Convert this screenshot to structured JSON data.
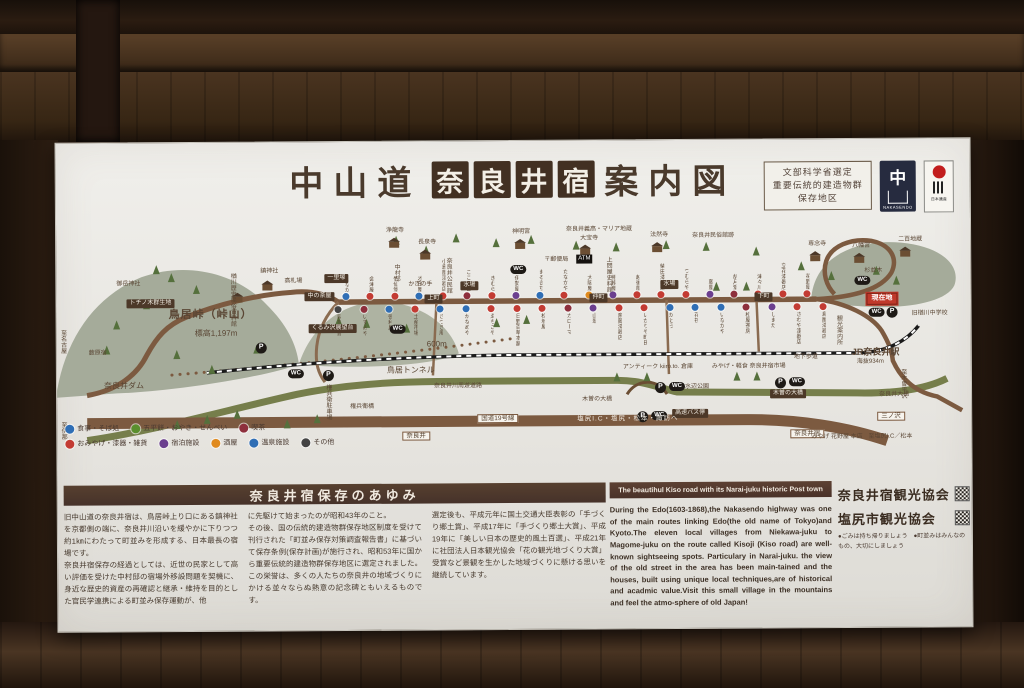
{
  "sign": {
    "title": {
      "prefix": "中山道",
      "highlight": [
        "奈",
        "良",
        "井",
        "宿"
      ],
      "suffix": "案内図"
    },
    "badges": {
      "selection": [
        "文部科学省選定",
        "重要伝統的建造物群",
        "保存地区"
      ],
      "nakasendo": {
        "char": "中",
        "caption": "NAKASENDO"
      },
      "heritage": {
        "caption": "日本遺産"
      }
    }
  },
  "map": {
    "labels": [
      {
        "x": 2,
        "y": 104,
        "t": "至名古屋",
        "k": "v"
      },
      {
        "x": 2,
        "y": 196,
        "t": "至伊那",
        "k": "v"
      },
      {
        "x": 32,
        "y": 125,
        "t": "薮原宿",
        "k": "t"
      },
      {
        "x": 60,
        "y": 56,
        "t": "御岳神社",
        "k": "t"
      },
      {
        "x": 70,
        "y": 74,
        "t": "トチノ木群生地",
        "k": "c"
      },
      {
        "x": 268,
        "y": 50,
        "t": "一里塚",
        "k": "c"
      },
      {
        "x": 248,
        "y": 68,
        "t": "中の茶屋",
        "k": "c"
      },
      {
        "x": 112,
        "y": 84,
        "t": "鳥居峠（峠山）",
        "k": "b"
      },
      {
        "x": 138,
        "y": 104,
        "t": "標高1,197m",
        "k": "p"
      },
      {
        "x": 252,
        "y": 100,
        "t": "くるみ沢展望台",
        "k": "c"
      },
      {
        "x": 370,
        "y": 116,
        "t": "600m",
        "k": "p"
      },
      {
        "x": 330,
        "y": 142,
        "t": "鳥居トンネル",
        "k": "p"
      },
      {
        "x": 47,
        "y": 156,
        "t": "奈良井ダム",
        "k": "p"
      },
      {
        "x": 172,
        "y": 48,
        "t": "楢川歴史民俗資料館",
        "k": "v"
      },
      {
        "x": 204,
        "y": 44,
        "t": "鎮神社",
        "k": "t"
      },
      {
        "x": 228,
        "y": 54,
        "t": "高札場",
        "k": "t"
      },
      {
        "x": 330,
        "y": 4,
        "t": "浄龍寺",
        "k": "t"
      },
      {
        "x": 362,
        "y": 16,
        "t": "長泉寺",
        "k": "t"
      },
      {
        "x": 388,
        "y": 34,
        "t": "奈良井公民館",
        "k": "v"
      },
      {
        "x": 336,
        "y": 40,
        "t": "中村邸",
        "k": "v"
      },
      {
        "x": 352,
        "y": 58,
        "t": "かぎの手",
        "k": "t"
      },
      {
        "x": 404,
        "y": 58,
        "t": "水場",
        "k": "c"
      },
      {
        "x": 604,
        "y": 58,
        "t": "水場",
        "k": "c"
      },
      {
        "x": 456,
        "y": 6,
        "t": "神明宮",
        "k": "t"
      },
      {
        "x": 488,
        "y": 34,
        "t": "〒郵便局",
        "k": "t"
      },
      {
        "x": 520,
        "y": 32,
        "t": "ATM",
        "k": "cb"
      },
      {
        "x": 510,
        "y": 4,
        "t": "奈良井義高・マリア地蔵",
        "k": "t"
      },
      {
        "x": 524,
        "y": 13,
        "t": "大宝寺",
        "k": "t"
      },
      {
        "x": 594,
        "y": 10,
        "t": "法然寺",
        "k": "t"
      },
      {
        "x": 636,
        "y": 11,
        "t": "奈良井民俗館跡",
        "k": "t"
      },
      {
        "x": 548,
        "y": 34,
        "t": "上問屋史料館",
        "k": "v"
      },
      {
        "x": 752,
        "y": 20,
        "t": "専念寺",
        "k": "t"
      },
      {
        "x": 796,
        "y": 22,
        "t": "八幡宮",
        "k": "t"
      },
      {
        "x": 842,
        "y": 16,
        "t": "二百地蔵",
        "k": "t"
      },
      {
        "x": 808,
        "y": 47,
        "t": "杉並木",
        "k": "t"
      },
      {
        "x": 454,
        "y": 42,
        "t": "WC",
        "k": "w"
      },
      {
        "x": 798,
        "y": 55,
        "t": "WC",
        "k": "w"
      },
      {
        "x": 333,
        "y": 101,
        "t": "WC",
        "k": "w"
      },
      {
        "x": 231,
        "y": 145,
        "t": "WC",
        "k": "w"
      },
      {
        "x": 266,
        "y": 146,
        "t": "P",
        "k": "pk"
      },
      {
        "x": 199,
        "y": 118,
        "t": "P",
        "k": "pk"
      },
      {
        "x": 830,
        "y": 86,
        "t": "P",
        "k": "pk"
      },
      {
        "x": 812,
        "y": 87,
        "t": "WC",
        "k": "w"
      },
      {
        "x": 598,
        "y": 160,
        "t": "P",
        "k": "pk"
      },
      {
        "x": 612,
        "y": 160,
        "t": "WC",
        "k": "w"
      },
      {
        "x": 580,
        "y": 189,
        "t": "P",
        "k": "pk"
      },
      {
        "x": 594,
        "y": 189,
        "t": "WC",
        "k": "w"
      },
      {
        "x": 718,
        "y": 156,
        "t": "P",
        "k": "pk"
      },
      {
        "x": 732,
        "y": 156,
        "t": "WC",
        "k": "w"
      },
      {
        "x": 810,
        "y": 72,
        "t": "現在地",
        "k": "here"
      },
      {
        "x": 778,
        "y": 94,
        "t": "観光案内所",
        "k": "v"
      },
      {
        "x": 795,
        "y": 126,
        "t": "JR奈良井駅",
        "k": "pb"
      },
      {
        "x": 800,
        "y": 138,
        "t": "海抜934m",
        "k": "t"
      },
      {
        "x": 855,
        "y": 90,
        "t": "旧楢川中学校",
        "k": "t"
      },
      {
        "x": 737,
        "y": 133,
        "t": "地下歩道",
        "k": "t"
      },
      {
        "x": 566,
        "y": 142,
        "t": "アンティーク kiiro.to. 倉庫",
        "k": "t"
      },
      {
        "x": 655,
        "y": 142,
        "t": "みやげ・軽食 奈良井宿市場",
        "k": "t"
      },
      {
        "x": 377,
        "y": 160,
        "t": "奈良井川周遊道路",
        "k": "t"
      },
      {
        "x": 267,
        "y": 160,
        "t": "権兵衛駐車場",
        "k": "v"
      },
      {
        "x": 293,
        "y": 180,
        "t": "権兵衛橋",
        "k": "t"
      },
      {
        "x": 628,
        "y": 162,
        "t": "水辺公園",
        "k": "t"
      },
      {
        "x": 713,
        "y": 168,
        "t": "木曽の大橋",
        "k": "c"
      },
      {
        "x": 525,
        "y": 174,
        "t": "木曽の大橋",
        "k": "t"
      },
      {
        "x": 615,
        "y": 187,
        "t": "高速バス停",
        "k": "c"
      },
      {
        "x": 345,
        "y": 208,
        "t": "奈良井",
        "k": "x"
      },
      {
        "x": 733,
        "y": 208,
        "t": "奈良井宿",
        "k": "x"
      },
      {
        "x": 822,
        "y": 171,
        "t": "奈良井大橋",
        "k": "t"
      },
      {
        "x": 820,
        "y": 191,
        "t": "三ノ沢",
        "k": "x"
      },
      {
        "x": 842,
        "y": 148,
        "t": "至木曽平沢",
        "k": "v"
      },
      {
        "x": 754,
        "y": 213,
        "t": "みやげ 花野屋 本店　至塩尻I.C／松本",
        "k": "t"
      },
      {
        "x": 420,
        "y": 191,
        "t": "国道19号線",
        "k": "x"
      },
      {
        "x": 520,
        "y": 193,
        "t": "塩尻I.C・塩尻・松本・諏訪へ",
        "k": "band"
      },
      {
        "x": 368,
        "y": 71,
        "t": "上町",
        "k": "c"
      },
      {
        "x": 533,
        "y": 71,
        "t": "仲町",
        "k": "c"
      },
      {
        "x": 698,
        "y": 71,
        "t": "下町",
        "k": "c"
      }
    ],
    "shops_upper": [
      {
        "n": "山なか",
        "c": "#2f6eb5"
      },
      {
        "n": "会津屋",
        "c": "#c33b33"
      },
      {
        "n": "竹仙堂",
        "c": "#c33b33"
      },
      {
        "n": "才田屋",
        "c": "#2f6eb5"
      },
      {
        "n": "小島屋漆器店",
        "c": "#c33b33"
      },
      {
        "n": "こころ音",
        "c": "#8e2f3c"
      },
      {
        "n": "きむら",
        "c": "#c33b33"
      },
      {
        "n": "伊勢屋",
        "c": "#6b3f8f"
      },
      {
        "n": "まるきち",
        "c": "#2f6eb5"
      },
      {
        "n": "たなかや",
        "c": "#c33b33"
      },
      {
        "n": "大阪屋",
        "c": "#e08a1e"
      },
      {
        "n": "相模屋",
        "c": "#6b3f8f"
      },
      {
        "n": "越後屋",
        "c": "#c33b33"
      },
      {
        "n": "柴田漆器店",
        "c": "#c33b33"
      },
      {
        "n": "つむらや",
        "c": "#c33b33"
      },
      {
        "n": "藤屋",
        "c": "#6b3f8f"
      },
      {
        "n": "胡月堂",
        "c": "#8e2f3c"
      },
      {
        "n": "津々川",
        "c": "#c33b33"
      },
      {
        "n": "立花漆器店",
        "c": "#c33b33"
      },
      {
        "n": "花野屋",
        "c": "#c33b33"
      }
    ],
    "shops_lower": [
      {
        "n": "民芸会館",
        "c": "#444444"
      },
      {
        "n": "いずみや",
        "c": "#8e2f3c"
      },
      {
        "n": "徳利屋",
        "c": "#2f6eb5"
      },
      {
        "n": "土産市場",
        "c": "#c33b33"
      },
      {
        "n": "さつき庵",
        "c": "#2f6eb5"
      },
      {
        "n": "かなめや",
        "c": "#2f6eb5"
      },
      {
        "n": "ゑちごや",
        "c": "#c33b33"
      },
      {
        "n": "日野百草本舗",
        "c": "#c33b33"
      },
      {
        "n": "松坂屋",
        "c": "#c33b33"
      },
      {
        "n": "カローマ",
        "c": "#8e2f3c"
      },
      {
        "n": "山翠",
        "c": "#6b3f8f"
      },
      {
        "n": "斎藤漆器店",
        "c": "#c33b33"
      },
      {
        "n": "いかりや町田",
        "c": "#c33b33"
      },
      {
        "n": "かとう",
        "c": "#2f6eb5"
      },
      {
        "n": "花筏",
        "c": "#2f6eb5"
      },
      {
        "n": "いなかや",
        "c": "#2f6eb5"
      },
      {
        "n": "松屋茶房",
        "c": "#8e2f3c"
      },
      {
        "n": "しまだ",
        "c": "#6b3f8f"
      },
      {
        "n": "さわや漆器店",
        "c": "#c33b33"
      },
      {
        "n": "島屋漆器店",
        "c": "#c33b33"
      }
    ],
    "legend": {
      "row1": [
        {
          "label": "食事・そば処",
          "color": "#2f6eb5"
        },
        {
          "label": "五平餅・おやき・せんべい",
          "color": "#5a8f2e"
        },
        {
          "label": "喫茶",
          "color": "#8e2f3c"
        }
      ],
      "row2": [
        {
          "label": "おみやげ・漆器・雑貨",
          "color": "#c33b33"
        },
        {
          "label": "宿泊施設",
          "color": "#6b3f8f"
        },
        {
          "label": "酒屋",
          "color": "#e08a1e"
        },
        {
          "label": "温泉施設",
          "color": "#2f6eb5"
        },
        {
          "label": "その他",
          "color": "#444444"
        }
      ]
    }
  },
  "history": {
    "heading": "奈良井宿保存のあゆみ",
    "col1": "旧中山道の奈良井宿は、鳥居峠上り口にある鎮神社を京都側の端に、奈良井川沿いを緩やかに下りつつ約1㎞にわたって町並みを形成する、日本最長の宿場です。\n奈良井宿保存の経過としては、近世の民家として高い評価を受けた中村邸の宿場外移設問題を契機に、身近な歴史的資産の再確認と継承・維持を目的とした官民学連携による町並み保存運動が、他",
    "col2": "に先駆けて始まったのが昭和43年のこと。\nその後、国の伝統的建造物群保存地区制度を受けて刊行された「町並み保存対策調査報告書」に基づいて保存条例(保存計画)が施行され、昭和53年に国から重要伝統的建造物群保存地区に選定されました。この栄誉は、多くの人たちの奈良井の地域づくりにかける並々ならぬ熱意の記念碑ともいえるものです。",
    "col3": "選定後も、平成元年に国土交通大臣表彰の「手づくり郷土賞」、平成17年に「手づくり郷土大賞」、平成19年に「美しい日本の歴史的風土百選」、平成21年に社団法人日本観光協会「花の観光地づくり大賞」受賞など景観を生かした地域づくりに懸ける思いを継続しています。"
  },
  "english": {
    "heading": "The beautihul Kiso road with its Narai-juku historic Post town",
    "body": "During the Edo(1603-1868),the Nakasendo highway was one of the main routes linking Edo(the old name of Tokyo)and Kyoto.The eleven local villages from Niekawa-juku to Magome-juku on the route called Kisoji (Kiso road) are well-known sightseeing spots. Particulary in Narai-juku. the view of the old street in the area has been main-tained and the houses, built using unique local techniques,are of historical and acadmic value.Visit this small village in the mountains and feel the atmo-sphere of old Japan!"
  },
  "associations": {
    "line1": "奈良井宿観光協会",
    "line2": "塩尻市観光協会",
    "notes": "●ごみは持ち帰りましょう　●町並みはみんなのもの、大切にしましょう"
  }
}
